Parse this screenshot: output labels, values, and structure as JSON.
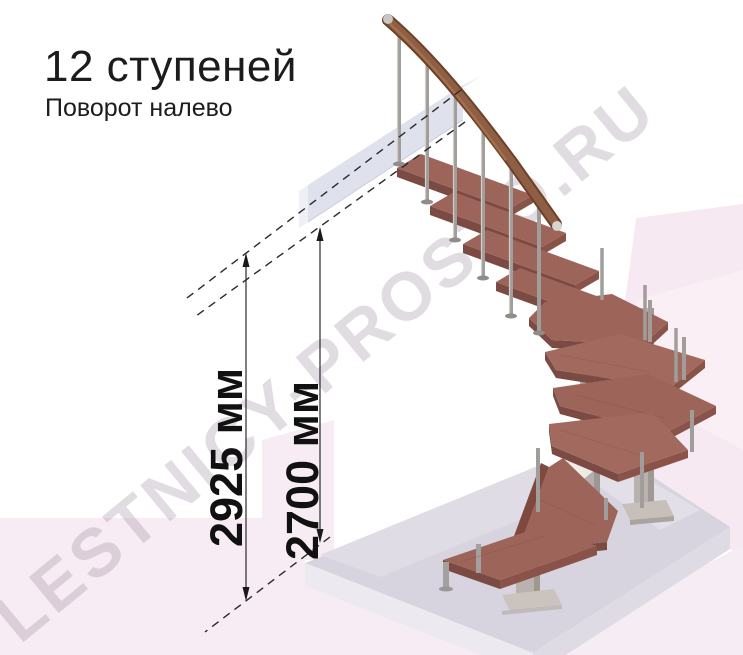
{
  "header": {
    "title": "12 ступеней",
    "subtitle": "Поворот налево"
  },
  "dimensions": {
    "overall": "2925 мм",
    "floor_to_ceiling": "2700 мм"
  },
  "watermark": "LESTNICY-PROSTO.RU",
  "scene": {
    "steps_count": 12,
    "turn": "left",
    "colors": {
      "tread_top": "#9d6459",
      "tread_front": "#7b4a42",
      "handrail": "#8a573b",
      "baluster_metal": "#a09d9a",
      "column": "#b6afac",
      "floor_slab": "#d7d4df",
      "landing_slab": "#dfe1ed",
      "background_pink": "#f7ecf3",
      "dimension_lines": "#1a1a1a"
    }
  }
}
